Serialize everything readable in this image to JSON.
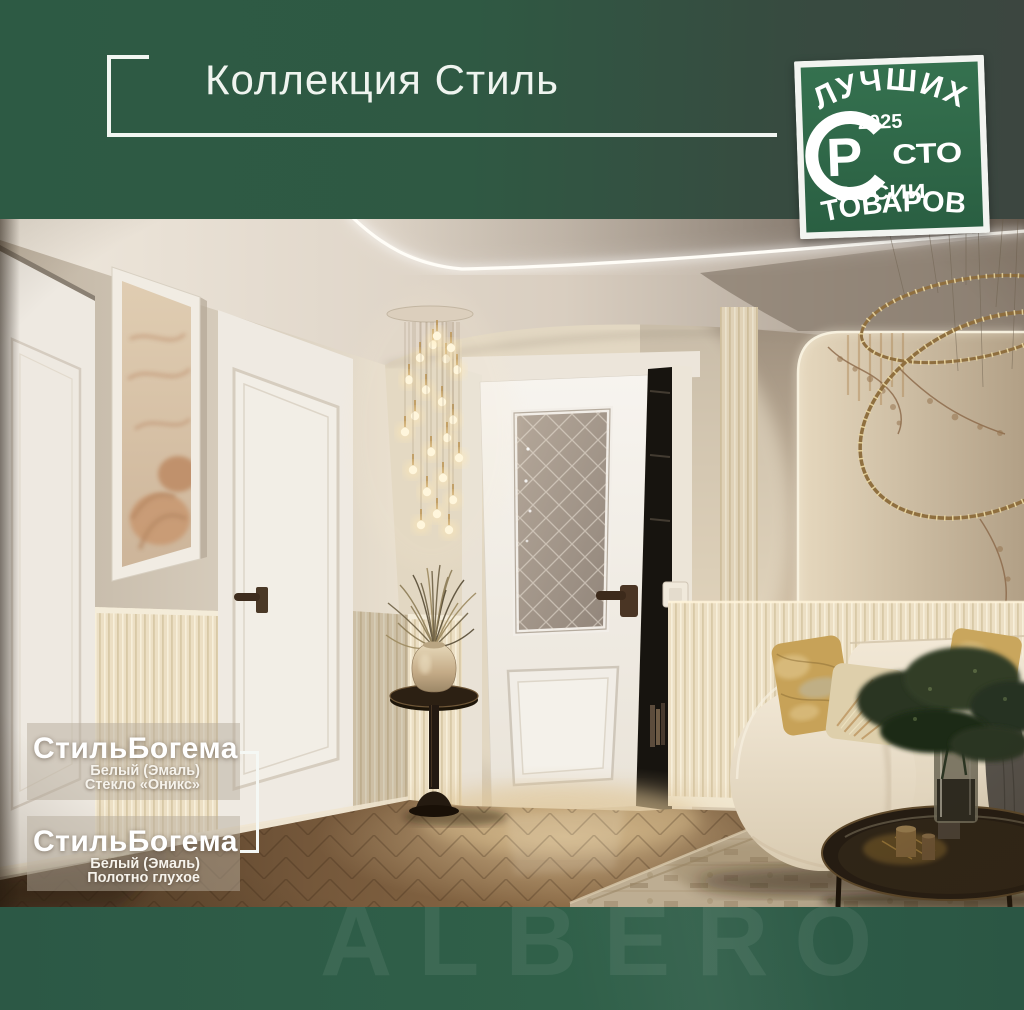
{
  "header": {
    "title": "Коллекция Стиль"
  },
  "badge": {
    "arc_top": "ЛУЧШИХ",
    "year": "2025",
    "letter": "Р",
    "sto": "СТО",
    "rossii_tail": "ОССИИ",
    "bottom": "ТОВАРОВ"
  },
  "products": [
    {
      "name": "СтильБогема",
      "finish": "Белый (Эмаль)",
      "variant": "Стекло «Оникс»"
    },
    {
      "name": "СтильБогема",
      "finish": "Белый (Эмаль)",
      "variant": "Полотно глухое"
    }
  ],
  "footer": {
    "watermark": "ALBERO"
  },
  "colors": {
    "header_green": "#2e5b45",
    "header_green_dark": "#3c4740",
    "badge_green": "#2e6a49",
    "footer_green": "#2e5a46",
    "text_white": "#f2f6f2",
    "label_panel": "rgba(182,172,156,0.5)"
  },
  "scene": {
    "elements": [
      "left-door",
      "wall-artwork",
      "second-left-door",
      "cascade-pendant-light",
      "featured-glass-door",
      "door-handle",
      "doorway-gap",
      "light-switch",
      "fluted-pilaster",
      "mural-wall-panel",
      "ring-chandelier",
      "wainscot",
      "sofa",
      "pillows",
      "throw-blanket",
      "plant-vase",
      "coffee-table",
      "candles",
      "side-table",
      "dried-plant",
      "rug",
      "herringbone-floor"
    ]
  }
}
